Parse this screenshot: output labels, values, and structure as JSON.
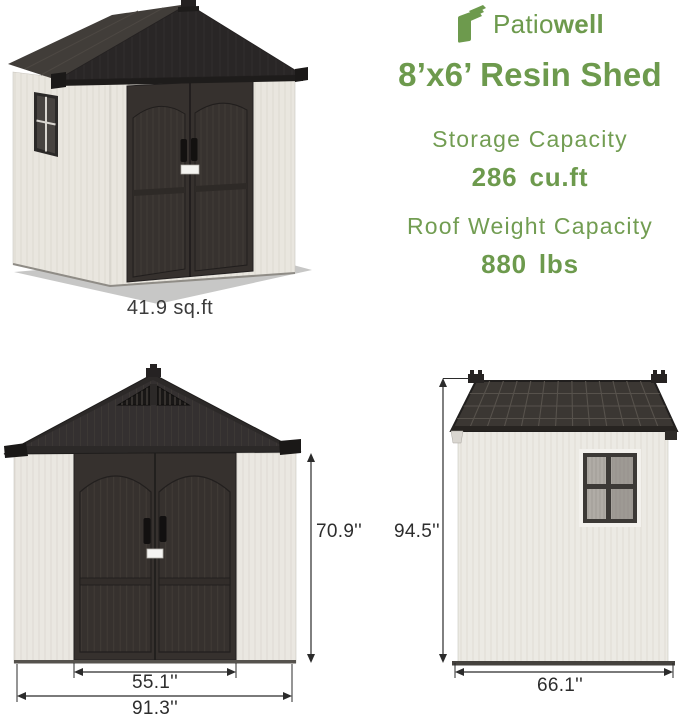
{
  "brand": {
    "name_part1": "Patio",
    "name_part2": "well",
    "logo_icon": "stacked-leaves-book-icon"
  },
  "title": "8’x6’ Resin Shed",
  "specs": [
    {
      "label": "Storage Capacity",
      "value": "286 cu.ft"
    },
    {
      "label": "Roof Weight Capacity",
      "value": "880 lbs"
    }
  ],
  "views": {
    "perspective": {
      "caption": "41.9 sq.ft"
    },
    "front": {
      "height_label": "70.9''",
      "door_width_label": "55.1''",
      "total_width_label": "91.3''"
    },
    "side": {
      "height_label": "94.5''",
      "depth_label": "66.1''"
    }
  },
  "colors": {
    "brand_green": "#6d9a4d",
    "dimension_text": "#2d2d2d",
    "caption_text": "#3b3b3b",
    "roof_dark": "#2b2827",
    "door_dark": "#37322f",
    "wall_light": "#ebe8e2",
    "shadow_gray": "#c7c7c6",
    "background": "#ffffff"
  }
}
